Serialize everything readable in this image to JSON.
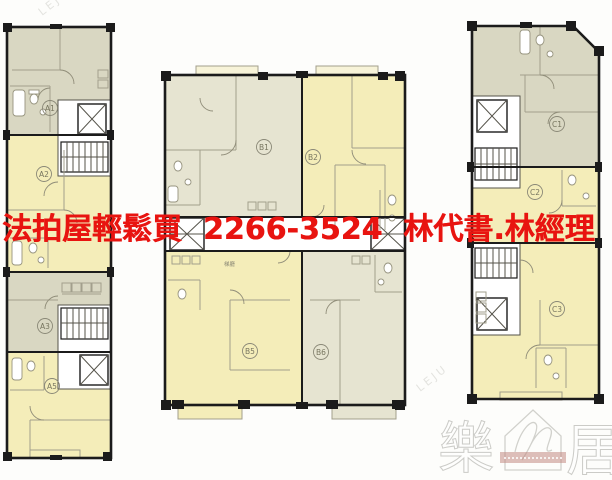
{
  "overlay": {
    "ad_text": "法拍屋輕鬆買  2266-3524  林代書.林經理",
    "color": "#e81410"
  },
  "plan": {
    "lobby_label": "梯廳",
    "wings": {
      "left": {
        "units": [
          {
            "id": "A1"
          },
          {
            "id": "A2"
          },
          {
            "id": "A3"
          },
          {
            "id": "A5"
          }
        ]
      },
      "center": {
        "units": [
          {
            "id": "B1"
          },
          {
            "id": "B2"
          },
          {
            "id": "B5"
          },
          {
            "id": "B6"
          }
        ]
      },
      "right": {
        "units": [
          {
            "id": "C1"
          },
          {
            "id": "C2"
          },
          {
            "id": "C3"
          }
        ]
      }
    },
    "colors": {
      "unit_yellow": "#f4edb9",
      "unit_gray": "#d9d7c2",
      "unit_cream": "#e6e4d1",
      "wall": "#1b1b1b"
    }
  },
  "watermark": {
    "char_left": "樂",
    "char_right": "居",
    "diagonal_text": "LEJU"
  }
}
